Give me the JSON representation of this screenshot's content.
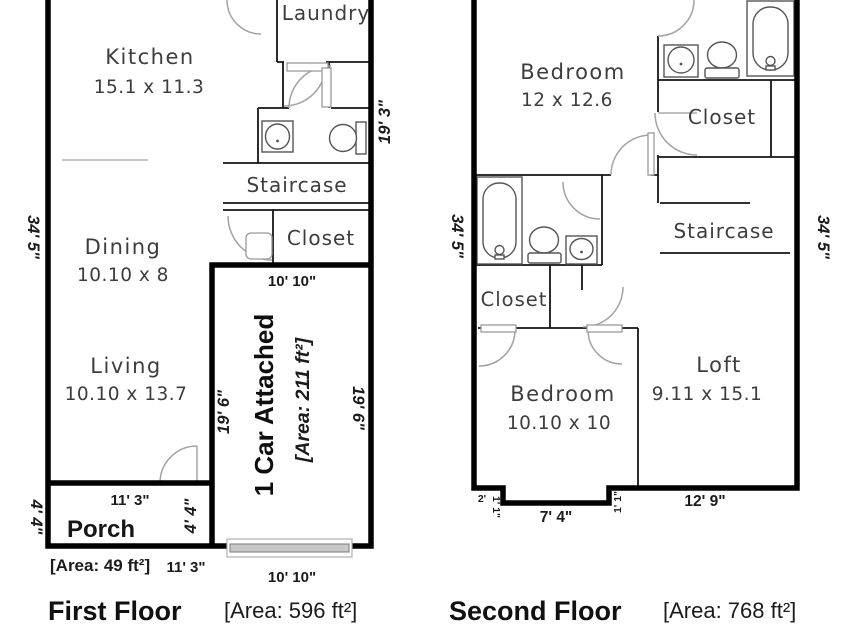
{
  "colors": {
    "wall": "#000000",
    "background": "#ffffff",
    "garage_door": "#c9c9c9",
    "room_label": "#3d3d3d",
    "dimension_label": "#1b1b1b"
  },
  "first_floor": {
    "caption": "First Floor",
    "area_label": "[Area: 596 ft²]",
    "rooms": {
      "kitchen": {
        "name": "Kitchen",
        "dims": "15.1 x 11.3"
      },
      "laundry": {
        "name": "Laundry"
      },
      "staircase": {
        "name": "Staircase"
      },
      "closet": {
        "name": "Closet"
      },
      "dining": {
        "name": "Dining",
        "dims": "10.10 x 8"
      },
      "living": {
        "name": "Living",
        "dims": "10.10 x 13.7"
      },
      "porch": {
        "name": "Porch",
        "area": "[Area: 49 ft²]"
      },
      "garage": {
        "name": "1 Car Attached",
        "area": "[Area: 211 ft²]"
      }
    },
    "dims": {
      "side_left": "34' 5\"",
      "side_right": "19' 3\"",
      "garage_top": "10' 10\"",
      "garage_bottom": "10' 10\"",
      "garage_left": "19' 6\"",
      "garage_right": "19' 6\"",
      "porch_top": "11' 3\"",
      "porch_bottom": "11' 3\"",
      "porch_left": "4' 4\"",
      "porch_right": "4' 4\""
    }
  },
  "second_floor": {
    "caption": "Second Floor",
    "area_label": "[Area: 768 ft²]",
    "rooms": {
      "bedroom_top": {
        "name": "Bedroom",
        "dims": "12 x 12.6"
      },
      "closet_top": {
        "name": "Closet"
      },
      "staircase": {
        "name": "Staircase"
      },
      "closet_mid": {
        "name": "Closet"
      },
      "bedroom_bottom": {
        "name": "Bedroom",
        "dims": "10.10 x 10"
      },
      "loft": {
        "name": "Loft",
        "dims": "9.11 x 15.1"
      }
    },
    "dims": {
      "side_left": "34' 5\"",
      "side_right": "34' 5\"",
      "notch_width": "2'",
      "notch_depth_left": "1' 1\"",
      "bottom_center": "7' 4\"",
      "notch_depth_right": "1' 1\"",
      "bottom_right": "12' 9\""
    }
  }
}
